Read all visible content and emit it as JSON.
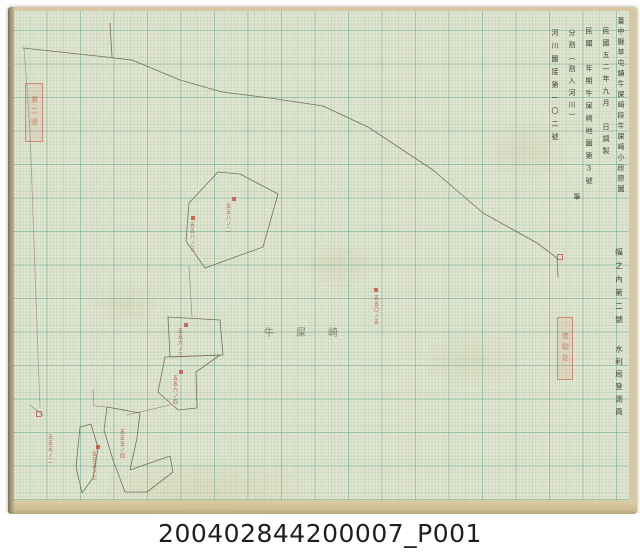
{
  "caption": "200402844200007_P001",
  "colors": {
    "paper": "#e1e4ce",
    "grid_major": "#46968a",
    "grid_minor": "#8cb996",
    "ink": "#76705f",
    "red_annotation": "#b5453a",
    "paper_edge": "#d5c8a2"
  },
  "margin": {
    "title_column": "臺中縣草屯鎮牛屎崎段牛屎崎小段原圖",
    "date_column": "民國五二年九月　日調製",
    "sheet_column": "民國　年期牛屎崎地圖第３號",
    "pen_note": "筆",
    "split_note": "分割（割入河川）",
    "river_note": "河川圖接第一〇二號",
    "set_note": "幅之內第二號",
    "surveyor_note": "水利局登測員"
  },
  "stamps": {
    "left": "第二號",
    "right": "查驗訖"
  },
  "map_label": "牛屎崎",
  "lots": [
    {
      "text": "五五八ノ三"
    },
    {
      "text": "五五八ノ二"
    },
    {
      "text": "五五〇ノ五"
    },
    {
      "text": "五五六ノ三"
    },
    {
      "text": "五五六ノ四"
    },
    {
      "text": "五五五ノ三"
    },
    {
      "text": "五五五ノ二"
    },
    {
      "text": "五五五ノ四"
    }
  ]
}
